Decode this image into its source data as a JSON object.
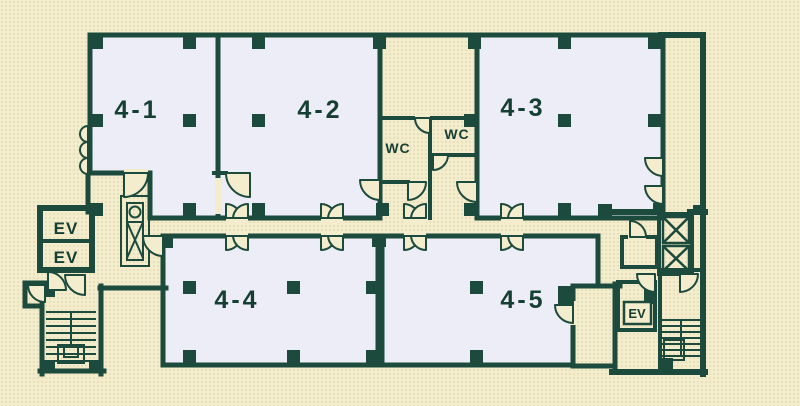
{
  "title": "4F floor plan",
  "colors": {
    "background": "#f3eccd",
    "dot": "#e7dfb6",
    "wall": "#1c4a3d",
    "room": "#ecedf7",
    "text": "#153f33"
  },
  "rooms": [
    {
      "id": "4-1",
      "label": "4-1"
    },
    {
      "id": "4-2",
      "label": "4-2"
    },
    {
      "id": "4-3",
      "label": "4-3"
    },
    {
      "id": "4-4",
      "label": "4-4"
    },
    {
      "id": "4-5",
      "label": "4-5"
    }
  ],
  "facilities": {
    "wc_left": "WC",
    "wc_right": "WC",
    "elevator_left_top": "EV",
    "elevator_left_bottom": "EV",
    "elevator_right": "EV"
  }
}
